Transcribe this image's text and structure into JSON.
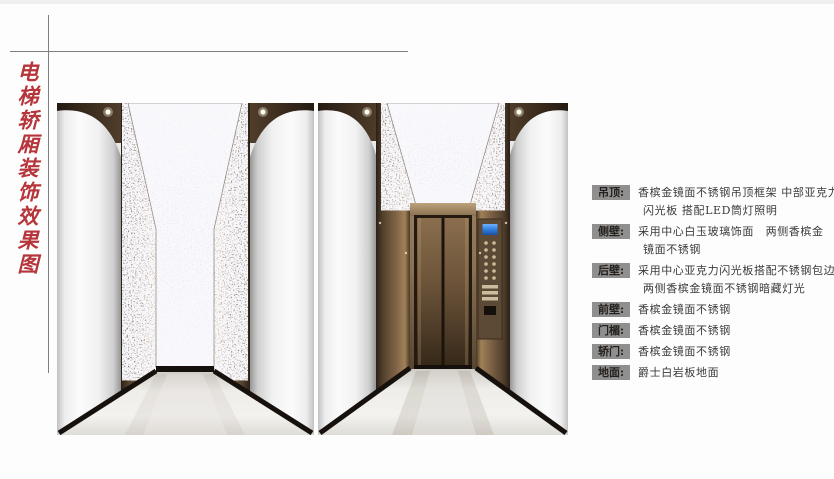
{
  "title": {
    "text": "电梯轿厢装饰效果图"
  },
  "specs": [
    {
      "label": "吊顶:",
      "line1": "香槟金镜面不锈钢吊顶框架 中部亚克力",
      "line2": "闪光板 搭配LED筒灯照明"
    },
    {
      "label": "侧壁:",
      "line1": "采用中心白玉玻璃饰面　两侧香槟金",
      "line2": "镜面不锈钢"
    },
    {
      "label": "后壁:",
      "line1": "采用中心亚克力闪光板搭配不锈钢包边",
      "line2": "两侧香槟金镜面不锈钢暗藏灯光"
    },
    {
      "label": "前壁:",
      "line1": "香槟金镜面不锈钢",
      "line2": ""
    },
    {
      "label": "门楣:",
      "line1": "香槟金镜面不锈钢",
      "line2": ""
    },
    {
      "label": "轿门:",
      "line1": "香槟金镜面不锈钢",
      "line2": ""
    },
    {
      "label": "地面:",
      "line1": "爵士白岩板地面",
      "line2": ""
    }
  ],
  "figures": {
    "left_label": "elevator-cab-interior-rear-wall-rendering",
    "right_label": "elevator-cab-interior-door-rendering"
  },
  "colors": {
    "accent_red": "#b5353a",
    "badge_bg": "#8f8f8f",
    "spec_text": "#3a3a3a",
    "crop_line_gray": "#7f7f7f",
    "bronze_champagne": "#8a7055",
    "sparkle_panel": "#e9e9ec",
    "marble_floor": "#eeede9",
    "cop_screen_blue": "#2f7fe0"
  }
}
